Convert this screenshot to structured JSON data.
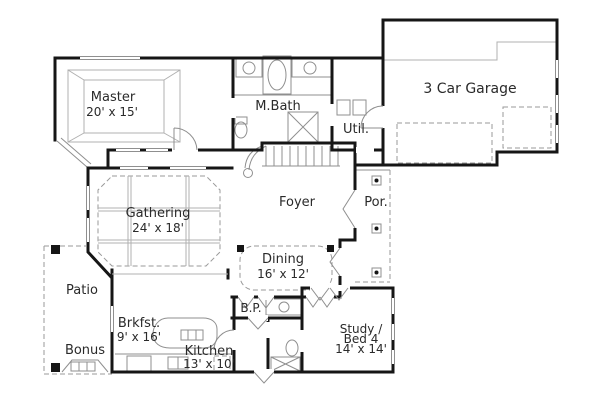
{
  "plan": {
    "type": "floor-plan",
    "rooms": {
      "master": {
        "label": "Master",
        "dims": "20' x 15'"
      },
      "mbath": {
        "label": "M.Bath"
      },
      "util": {
        "label": "Util."
      },
      "garage": {
        "label": "3 Car Garage"
      },
      "foyer": {
        "label": "Foyer"
      },
      "porch": {
        "label": "Por."
      },
      "gathering": {
        "label": "Gathering",
        "dims": "24' x 18'"
      },
      "dining": {
        "label": "Dining",
        "dims": "16' x 12'"
      },
      "patio": {
        "label": "Patio"
      },
      "bonus": {
        "label": "Bonus"
      },
      "breakfast": {
        "label": "Brkfst.",
        "dims": "9' x 16'"
      },
      "kitchen": {
        "label": "Kitchen",
        "dims": "13' x 10'"
      },
      "butlers_pantry": {
        "label": "B.P."
      },
      "study": {
        "label": "Study /",
        "label2": "Bed 4",
        "dims": "14' x 14'"
      }
    },
    "colors": {
      "background": "#ffffff",
      "wall": "#161616",
      "thin_line": "#8f8f8f",
      "text": "#2a2a2a"
    }
  }
}
